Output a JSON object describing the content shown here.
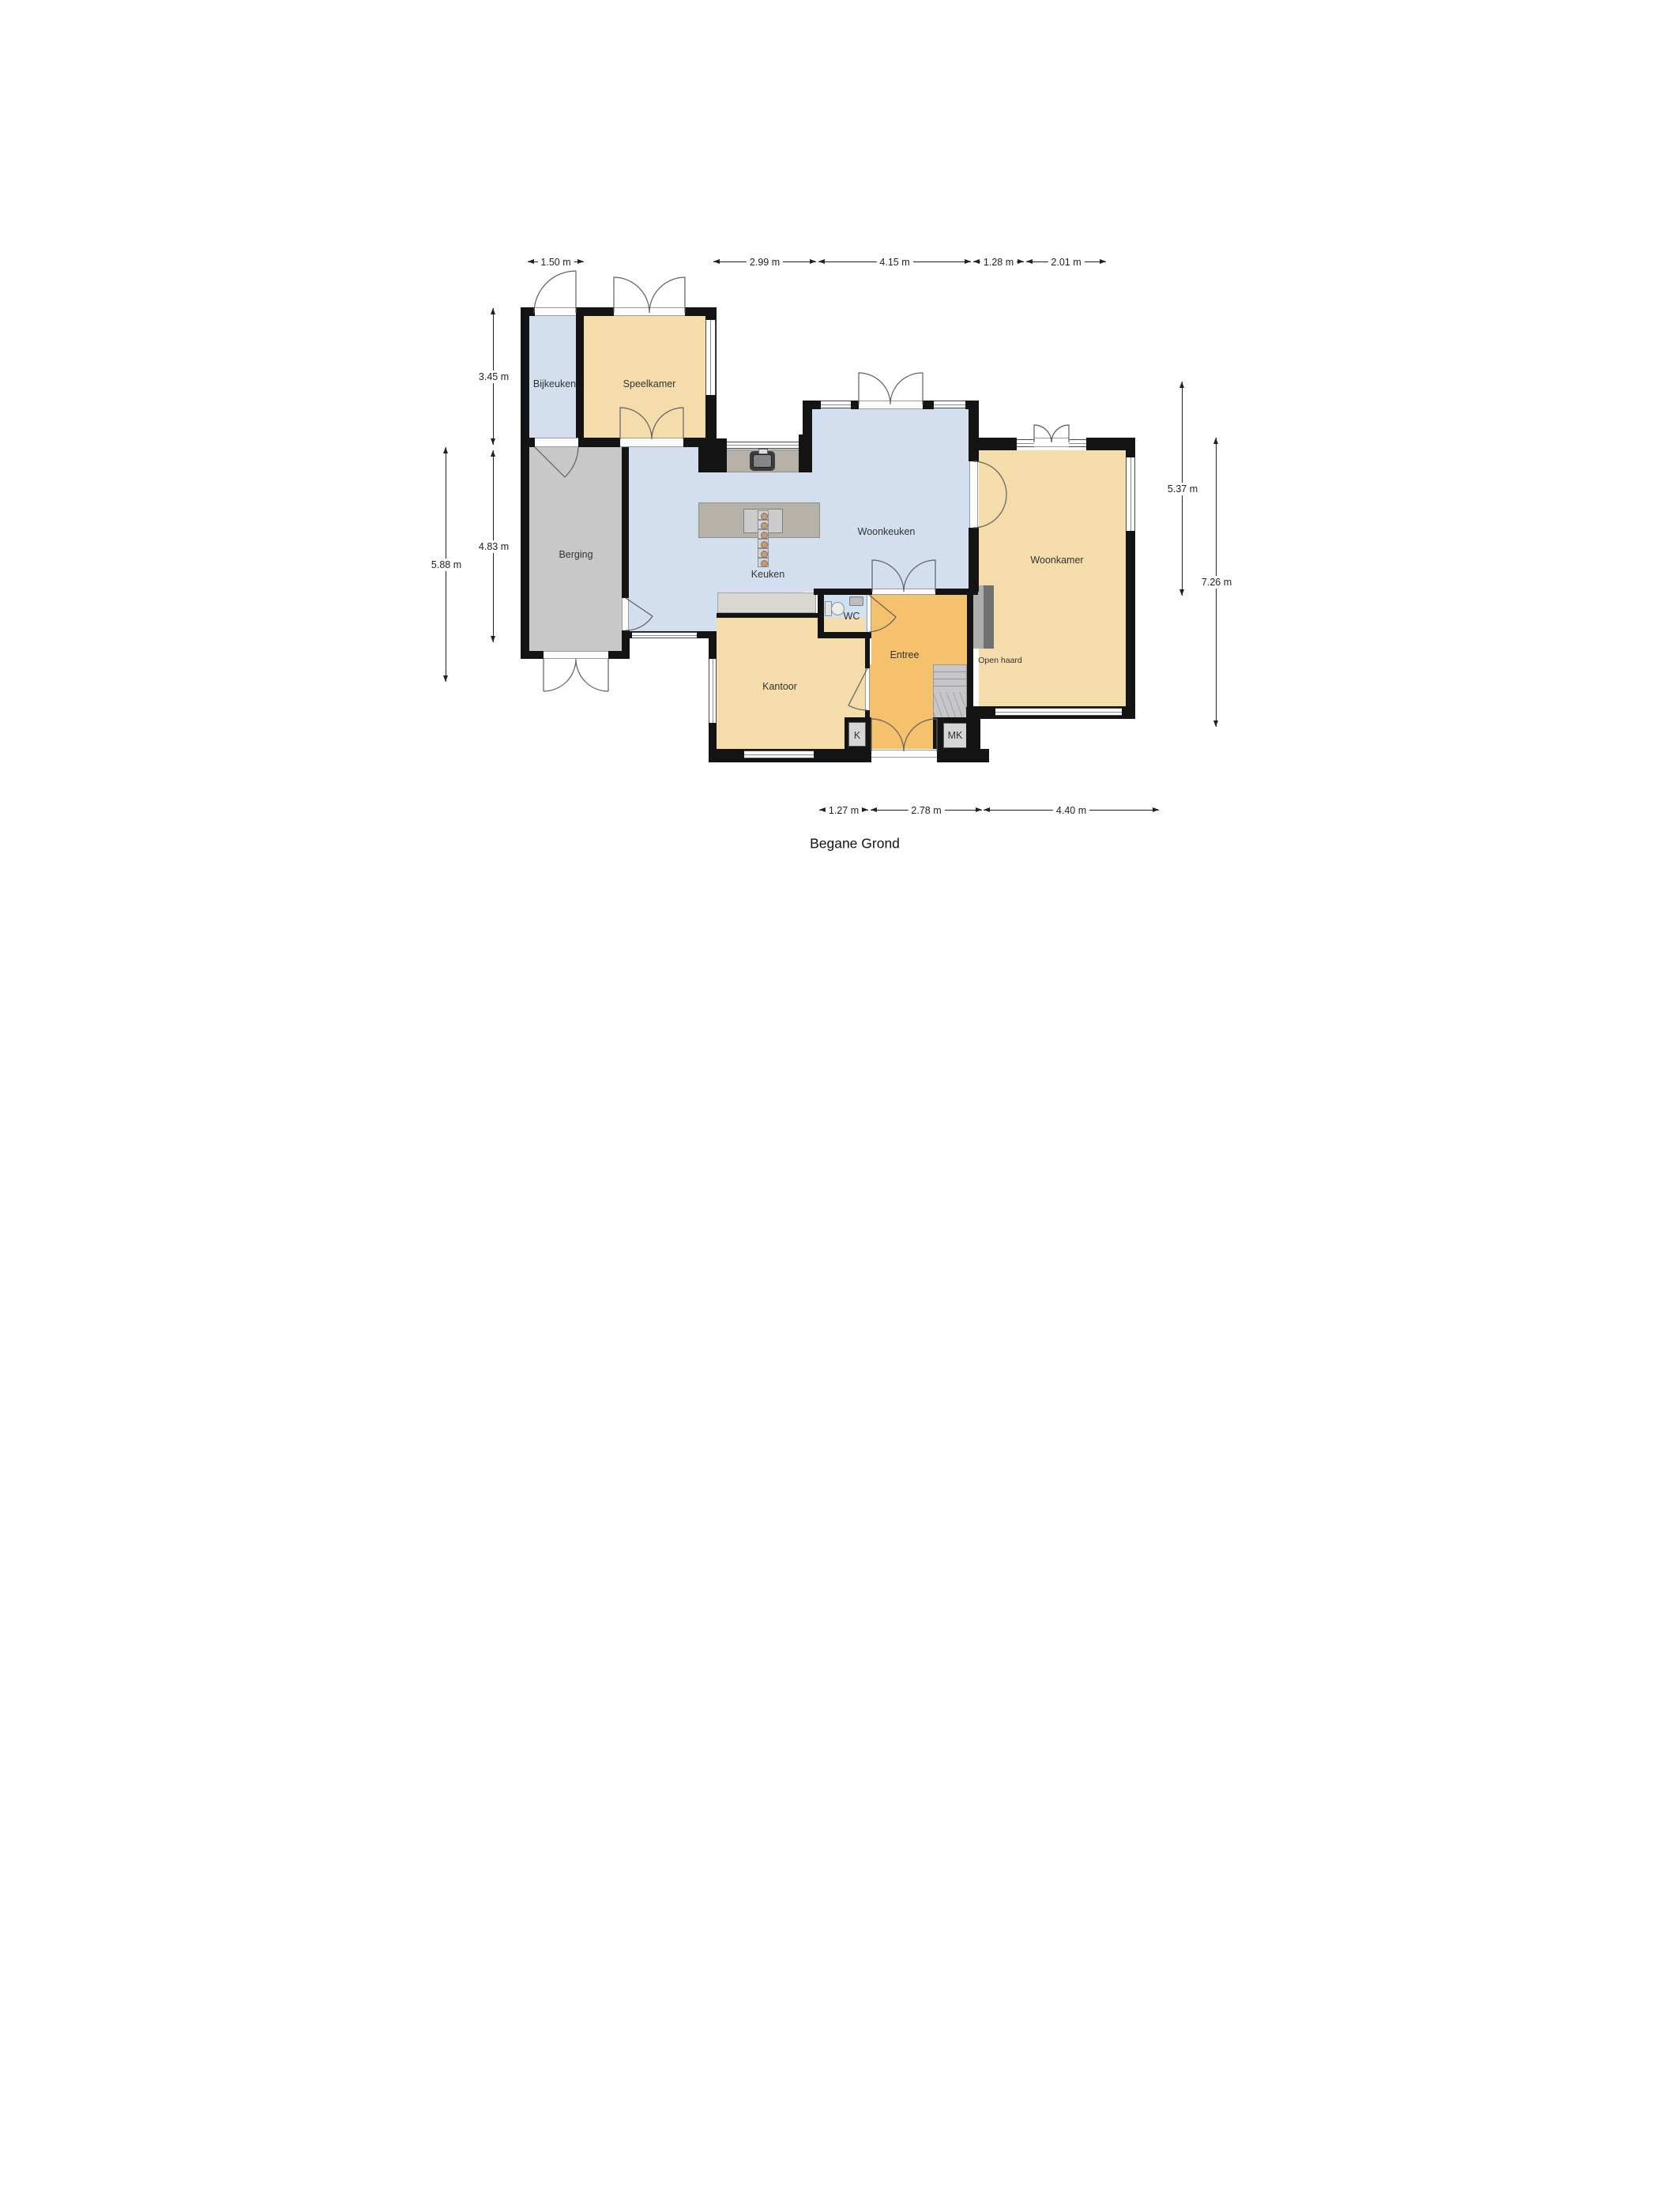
{
  "title": "Begane Grond",
  "rooms": {
    "bijkeuken": "Bijkeuken",
    "speelkamer": "Speelkamer",
    "berging": "Berging",
    "keuken": "Keuken",
    "woonkeuken": "Woonkeuken",
    "woonkamer": "Woonkamer",
    "kantoor": "Kantoor",
    "entree": "Entree",
    "wc": "WC",
    "k": "K",
    "mk": "MK",
    "open_haard": "Open haard"
  },
  "dimensions": {
    "top": [
      {
        "label": "1.50 m"
      },
      {
        "label": "2.99 m"
      },
      {
        "label": "4.15 m"
      },
      {
        "label": "1.28 m"
      },
      {
        "label": "2.01 m"
      }
    ],
    "left": [
      {
        "label": "3.45 m"
      },
      {
        "label": "4.83 m"
      },
      {
        "label": "5.88 m"
      }
    ],
    "right": [
      {
        "label": "5.37 m"
      },
      {
        "label": "7.26 m"
      }
    ],
    "bottom": [
      {
        "label": "1.27 m"
      },
      {
        "label": "2.78 m"
      },
      {
        "label": "4.40 m"
      }
    ]
  },
  "colors": {
    "wall": "#141414",
    "room_tan": "#f4dcab",
    "room_blue": "#d3dfee",
    "room_gray": "#c8c8c8",
    "entree_orange": "#f6c16c",
    "wc_blue": "#d0e2f2",
    "counter": "#b6b2a9"
  }
}
